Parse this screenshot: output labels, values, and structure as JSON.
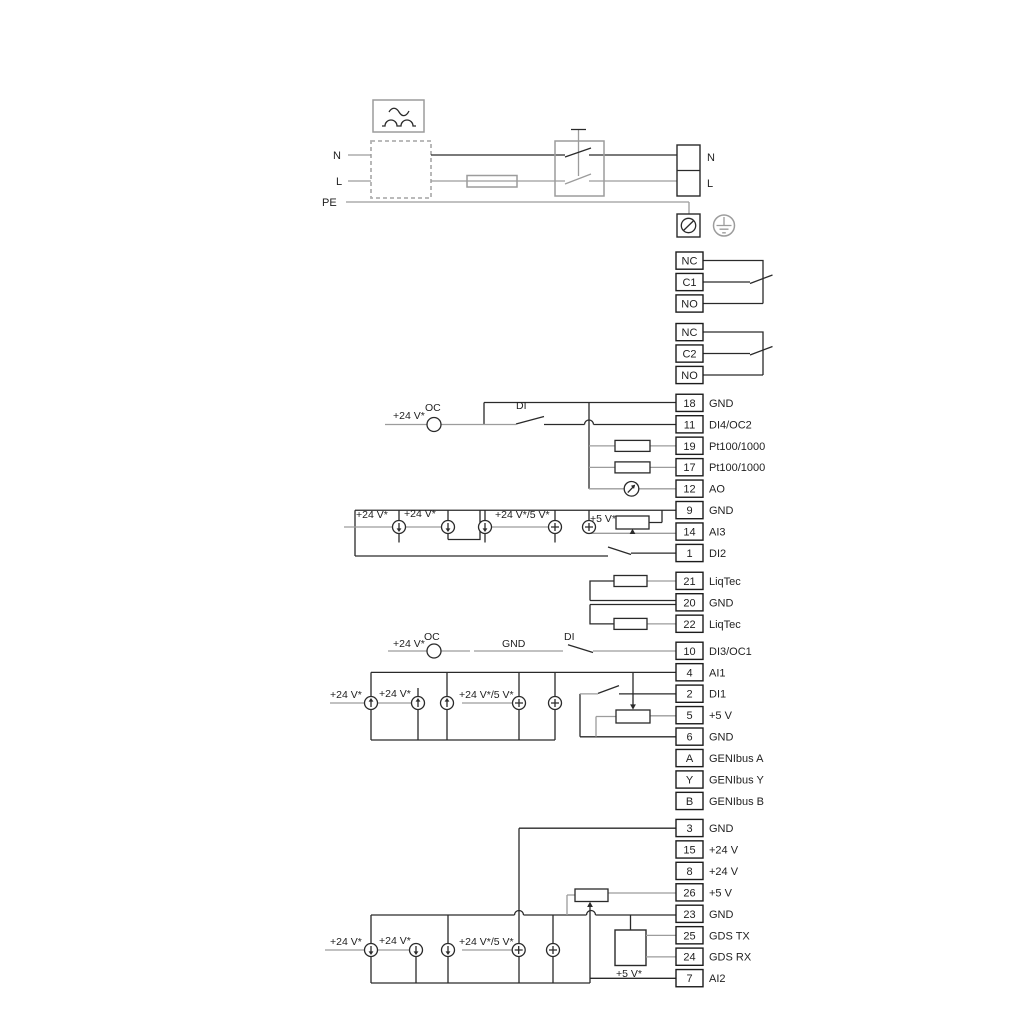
{
  "colors": {
    "background": "#ffffff",
    "wire_gray": "#9c9c9c",
    "line_dark": "#2a2a2a",
    "text": "#1f1f1f"
  },
  "power": {
    "left": [
      "N",
      "L",
      "PE"
    ],
    "right": [
      "N",
      "L"
    ]
  },
  "relays": [
    [
      "NC",
      "C1",
      "NO"
    ],
    [
      "NC",
      "C2",
      "NO"
    ]
  ],
  "strips": [
    [
      [
        "18",
        "GND"
      ],
      [
        "11",
        "DI4/OC2"
      ],
      [
        "19",
        "Pt100/1000"
      ],
      [
        "17",
        "Pt100/1000"
      ],
      [
        "12",
        "AO"
      ],
      [
        "9",
        "GND"
      ],
      [
        "14",
        "AI3"
      ],
      [
        "1",
        "DI2"
      ]
    ],
    [
      [
        "21",
        "LiqTec"
      ],
      [
        "20",
        "GND"
      ],
      [
        "22",
        "LiqTec"
      ]
    ],
    [
      [
        "10",
        "DI3/OC1"
      ],
      [
        "4",
        "AI1"
      ],
      [
        "2",
        "DI1"
      ],
      [
        "5",
        "+5 V"
      ],
      [
        "6",
        "GND"
      ],
      [
        "A",
        "GENIbus A"
      ],
      [
        "Y",
        "GENIbus Y"
      ],
      [
        "B",
        "GENIbus B"
      ]
    ],
    [
      [
        "3",
        "GND"
      ],
      [
        "15",
        "+24 V"
      ],
      [
        "8",
        "+24 V"
      ],
      [
        "26",
        "+5 V"
      ],
      [
        "23",
        "GND"
      ],
      [
        "25",
        "GDS TX"
      ],
      [
        "24",
        "GDS RX"
      ],
      [
        "7",
        "AI2"
      ]
    ]
  ],
  "annotations": {
    "di4_supply": "+24 V*",
    "di4_oc": "OC",
    "di4_di": "DI",
    "ai3_v24_a": "+24 V*",
    "ai3_v24_b": "+24 V*",
    "ai3_mix": "+24 V*/5 V*",
    "ai3_v5": "+5 V*",
    "di3_supply": "+24 V*",
    "di3_oc": "OC",
    "di3_gnd": "GND",
    "di3_di": "DI",
    "ai1_v24_a": "+24 V*",
    "ai1_v24_b": "+24 V*",
    "ai1_mix": "+24 V*/5 V*",
    "ai2_v24_a": "+24 V*",
    "ai2_v24_b": "+24 V*",
    "ai2_mix": "+24 V*/5 V*",
    "ai2_v5": "+5 V*"
  }
}
